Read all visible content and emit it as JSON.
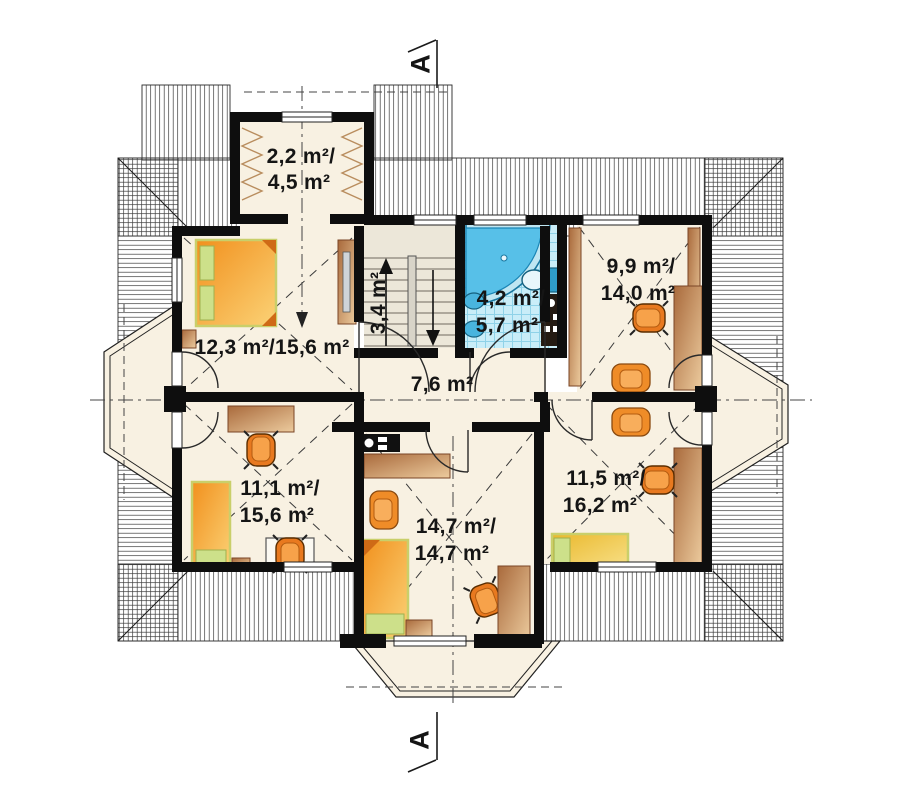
{
  "section_markers": {
    "top": "A",
    "bottom": "A"
  },
  "labels": {
    "dormer": {
      "line1": "2,2 m²/",
      "line2": "4,5 m²"
    },
    "bedroom_left": {
      "line1": "12,3 m²/15,6 m²"
    },
    "stairs": {
      "line1": "3,4 m²"
    },
    "bathroom": {
      "line1": "4,2 m²/",
      "line2": "5,7 m²"
    },
    "room_top_right": {
      "line1": "9,9 m²/",
      "line2": "14,0 m²"
    },
    "hallway": {
      "line1": "7,6 m²"
    },
    "room_bottom_left": {
      "line1": "11,1 m²/",
      "line2": "15,6 m²"
    },
    "room_bottom_middle": {
      "line1": "14,7 m²/",
      "line2": "14,7 m²"
    },
    "room_bottom_right": {
      "line1": "11,5 m²/",
      "line2": "16,2 m²"
    }
  },
  "colors": {
    "wall": "#0e0e0e",
    "floor": "#f8f1e2",
    "stairs_floor": "#ece7d9",
    "tile": "#c9edf8",
    "tub": "#57c0e8",
    "wood": "#c98c5f",
    "bed_orange": "#f5a11f",
    "bed_yellow": "#f2c945",
    "pillow_green": "#cde08a",
    "chair_orange": "#e8791f"
  }
}
